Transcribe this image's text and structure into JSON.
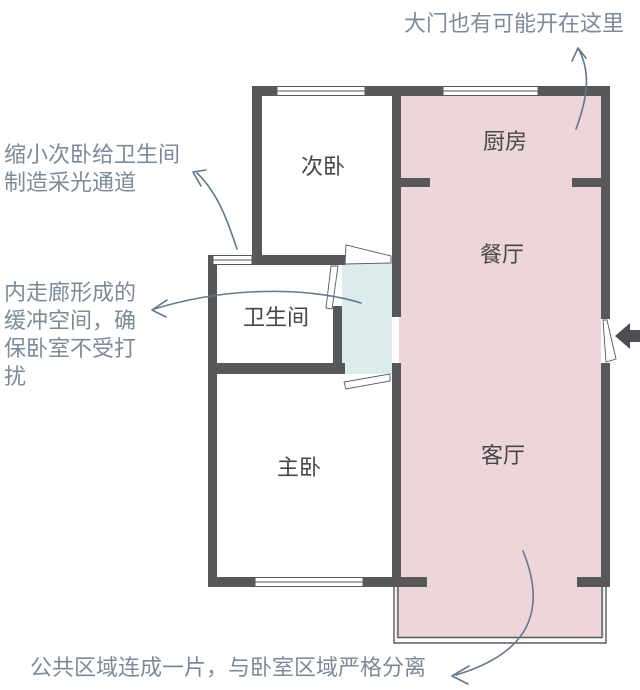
{
  "figure": {
    "type": "apartment floor plan"
  },
  "rooms": {
    "kitchen": {
      "label": "厨房"
    },
    "dining": {
      "label": "餐厅"
    },
    "living": {
      "label": "客厅"
    },
    "second_bedroom": {
      "label": "次卧"
    },
    "bathroom": {
      "label": "卫生间"
    },
    "master_bedroom": {
      "label": "主卧"
    }
  },
  "annotations": {
    "gate": {
      "text": "大门也有可能开在这里"
    },
    "light_channel": {
      "text": "缩小次卧给卫生间\n制造采光通道"
    },
    "corridor": {
      "text": "内走廊形成的\n缓冲空间，确\n保卧室不受打\n扰"
    },
    "separation": {
      "text": "公共区域连成一片，与卧室区域严格分离"
    }
  },
  "colors": {
    "background": "#ffffff",
    "wall": "#58585b",
    "public_fill": "#ecd6d9",
    "corridor_fill": "#dcebec",
    "room_label": "#474749",
    "annotation_text": "#7d8a98",
    "annotation_arrow": "#64788c",
    "entry_arrow": "#4d4f52"
  }
}
